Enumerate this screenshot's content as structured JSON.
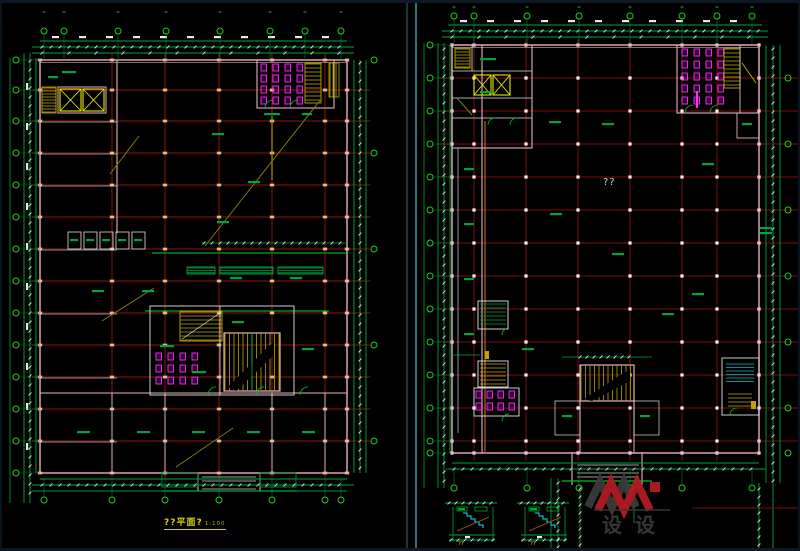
{
  "palette": {
    "background": "#000000",
    "line_green": "#00a33c",
    "bright_green": "#22cc22",
    "dim_white": "#e9e9e9",
    "grid_red_left": "#8f1212",
    "grid_red_right": "#7c0d0d",
    "wall_pink": "#e8b0bc",
    "wall_white": "#e2e2e2",
    "yellow": "#e8e800",
    "yellow_dim": "#b8a800",
    "magenta": "#ff2bff",
    "cyan_border": "#54bccf",
    "cyan_stair": "#00c0d0",
    "olive": "#7c7c14",
    "orange": "#b06820",
    "marker_fill": "#d2c47e",
    "title_yellow": "#d6d200"
  },
  "left_plan": {
    "title": "??平面?",
    "scale_label": "1:100"
  },
  "right_plan": {
    "center_label": "??"
  },
  "details": {
    "label_1": "??",
    "label_2": "??"
  },
  "watermark": {
    "text": "设设",
    "accent_color": "#b51c22",
    "gray_color": "#3c3c3c"
  }
}
